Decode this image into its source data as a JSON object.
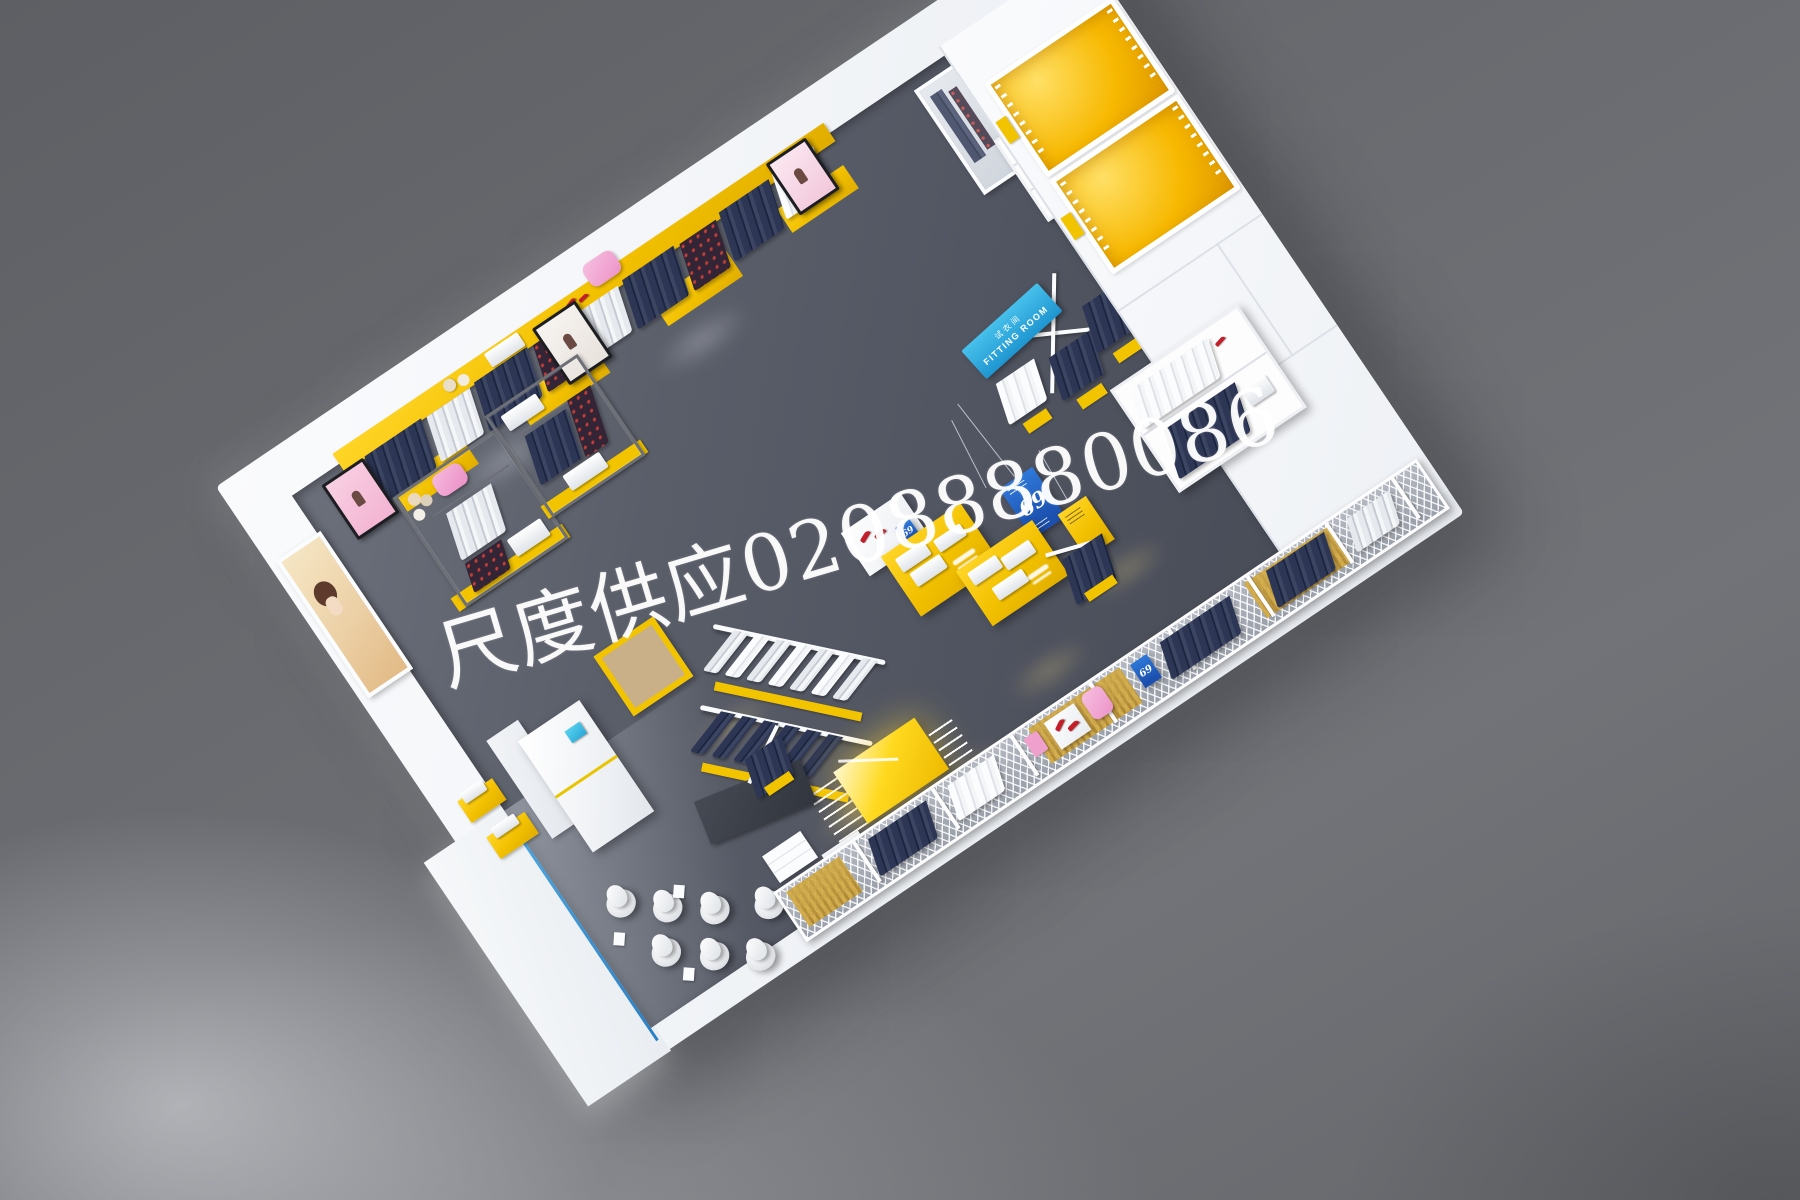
{
  "scene": {
    "description": "Top-down 3D render of a clothing retail store interior with yellow and white fixtures",
    "background_color": "#696b70",
    "floor_color": "#565a65",
    "wall_color": "#f3f5f8",
    "accent_yellow": "#f2c400",
    "accent_orange": "#f7b800",
    "accent_cyan": "#2fa9e0",
    "accent_blue": "#2263c9",
    "storefront_line_blue": "#3a93d2",
    "shoe_red": "#c31f2b",
    "bag_pink": "#f2a8d4"
  },
  "watermark": {
    "text": "尺度供应02088880086"
  },
  "signs": {
    "fitting_room": {
      "zh": "试衣间",
      "en": "FITTING ROOM"
    },
    "banner_69": {
      "text": "69"
    },
    "table_tag_69": {
      "text": "69"
    },
    "mesh_tag_69": {
      "text": "69"
    }
  },
  "fixtures": {
    "left_wall": [
      "poster-display",
      "cashier-counter",
      "cork-table",
      "yellow-wall-ledges",
      "storefront-glass-line"
    ],
    "top_wall": [
      "yellow-wall-shelving",
      "tv-screens",
      "mirror-panel",
      "white-shelf-unit",
      "pink-bag",
      "red-shoes"
    ],
    "interior": [
      "metal-frame-racks",
      "fitting-room-rack",
      "hanging-banners",
      "yellow-display-tables",
      "diagonal-garment-racks",
      "glowing-island-table",
      "dark-rug",
      "mannequin-group",
      "four-way-jeans-rack"
    ],
    "right_side": [
      "orange-fitting-rooms",
      "white-wardrobe-unit",
      "mesh-partition-wall"
    ]
  }
}
